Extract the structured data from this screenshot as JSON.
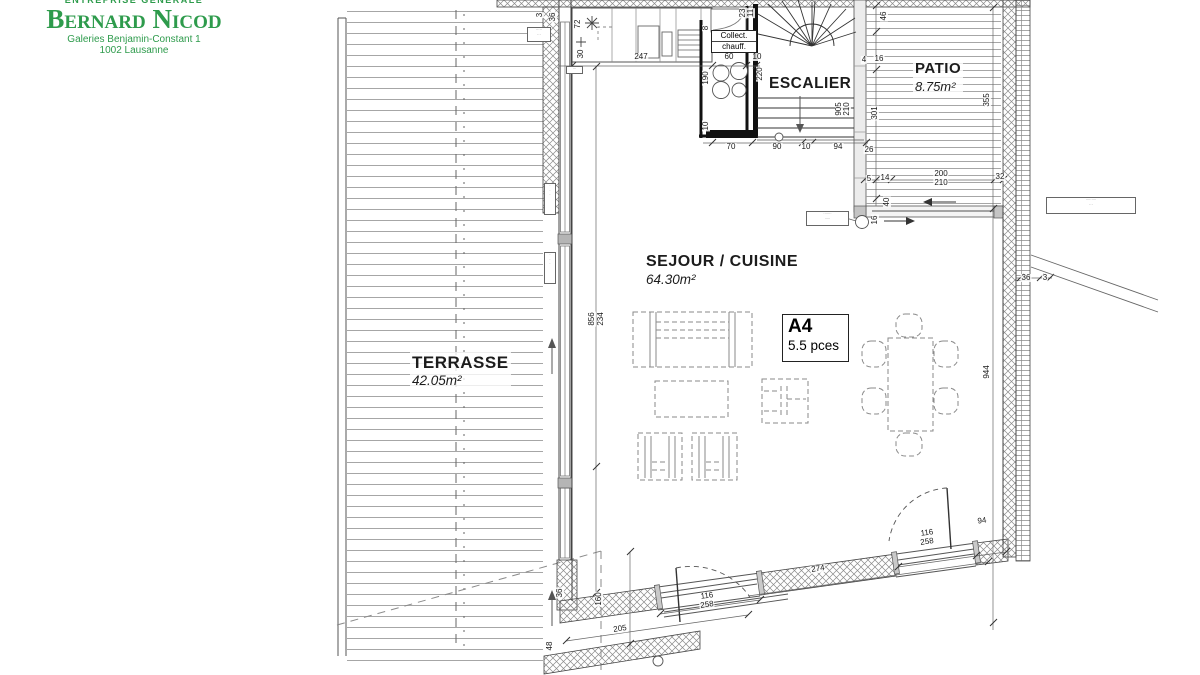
{
  "brand": {
    "tagline": "ENTREPRISE GÉNÉRALE",
    "name": "Bernard Nicod",
    "address_line1": "Galeries Benjamin-Constant 1",
    "address_line2": "1002 Lausanne",
    "color": "#2e9b4c"
  },
  "unit_badge": {
    "code": "A4",
    "size": "5.5 pces"
  },
  "rooms": [
    {
      "id": "terrasse",
      "label": "TERRASSE",
      "area": "42.05m²"
    },
    {
      "id": "sejour",
      "label": "SEJOUR / CUISINE",
      "area": "64.30m²"
    },
    {
      "id": "escalier",
      "label": "ESCALIER",
      "area": ""
    },
    {
      "id": "patio",
      "label": "PATIO",
      "area": "8.75m²"
    }
  ],
  "equipment": {
    "collect_line1": "Collect.",
    "collect_line2": "chauff."
  },
  "dimensions": [
    {
      "t": "247",
      "x": 641,
      "y": 57
    },
    {
      "t": "60",
      "x": 729,
      "y": 57
    },
    {
      "t": "10",
      "x": 757,
      "y": 57
    },
    {
      "t": "3",
      "x": 540,
      "y": 15,
      "r": -90
    },
    {
      "t": "36",
      "x": 553,
      "y": 17,
      "r": -90
    },
    {
      "t": "72",
      "x": 578,
      "y": 24,
      "r": -90
    },
    {
      "t": "30",
      "x": 581,
      "y": 54,
      "r": -90
    },
    {
      "t": "23",
      "x": 743,
      "y": 13,
      "r": -90
    },
    {
      "t": "11",
      "x": 751,
      "y": 13,
      "r": -90
    },
    {
      "t": "8",
      "x": 706,
      "y": 28,
      "r": -90
    },
    {
      "t": "190",
      "x": 706,
      "y": 78,
      "r": -90
    },
    {
      "t": "10",
      "x": 706,
      "y": 126,
      "r": -90
    },
    {
      "t": "220",
      "x": 760,
      "y": 74,
      "r": -90
    },
    {
      "t": "905",
      "x": 839,
      "y": 109,
      "r": -90
    },
    {
      "t": "210",
      "x": 847,
      "y": 109,
      "r": -90
    },
    {
      "t": "70",
      "x": 731,
      "y": 147
    },
    {
      "t": "90",
      "x": 777,
      "y": 147
    },
    {
      "t": "10",
      "x": 806,
      "y": 147
    },
    {
      "t": "94",
      "x": 838,
      "y": 147
    },
    {
      "t": "26",
      "x": 869,
      "y": 150
    },
    {
      "t": "46",
      "x": 884,
      "y": 16,
      "r": -90
    },
    {
      "t": "4",
      "x": 864,
      "y": 60
    },
    {
      "t": "16",
      "x": 879,
      "y": 59
    },
    {
      "t": "301",
      "x": 875,
      "y": 113,
      "r": -90
    },
    {
      "t": "355",
      "x": 987,
      "y": 100,
      "r": -90
    },
    {
      "t": "5",
      "x": 869,
      "y": 179
    },
    {
      "t": "14",
      "x": 885,
      "y": 178
    },
    {
      "t": "200",
      "x": 941,
      "y": 174
    },
    {
      "t": "210",
      "x": 941,
      "y": 183
    },
    {
      "t": "32",
      "x": 1000,
      "y": 177
    },
    {
      "t": "40",
      "x": 887,
      "y": 202,
      "r": -90
    },
    {
      "t": "16",
      "x": 875,
      "y": 220,
      "r": -90
    },
    {
      "t": "36",
      "x": 1026,
      "y": 278
    },
    {
      "t": "3",
      "x": 1045,
      "y": 278
    },
    {
      "t": "944",
      "x": 987,
      "y": 372,
      "r": -90
    },
    {
      "t": "856",
      "x": 592,
      "y": 319,
      "r": -90
    },
    {
      "t": "234",
      "x": 601,
      "y": 319,
      "r": -90
    },
    {
      "t": "36",
      "x": 560,
      "y": 593,
      "r": -90
    },
    {
      "t": "48",
      "x": 550,
      "y": 646,
      "r": -90
    },
    {
      "t": "160",
      "x": 599,
      "y": 599,
      "r": -90
    },
    {
      "t": "205",
      "x": 620,
      "y": 629,
      "r": -8
    },
    {
      "t": "274",
      "x": 818,
      "y": 569,
      "r": -8
    },
    {
      "t": "116",
      "x": 707,
      "y": 596,
      "r": -8
    },
    {
      "t": "258",
      "x": 707,
      "y": 605,
      "r": -8
    },
    {
      "t": "116",
      "x": 927,
      "y": 533,
      "r": -8
    },
    {
      "t": "258",
      "x": 927,
      "y": 542,
      "r": -8
    },
    {
      "t": "94",
      "x": 982,
      "y": 521,
      "r": -8
    }
  ],
  "annotations": [
    {
      "lines": [
        "·····",
        "···"
      ],
      "x": 527,
      "y": 27,
      "w": 22,
      "h": 13
    },
    {
      "lines": [
        "·",
        "·",
        "·"
      ],
      "x": 544,
      "y": 183,
      "w": 10,
      "h": 30
    },
    {
      "lines": [
        "·",
        "·",
        "·"
      ],
      "x": 544,
      "y": 252,
      "w": 10,
      "h": 30
    },
    {
      "lines": [
        "·······",
        "·····"
      ],
      "x": 806,
      "y": 211,
      "w": 41,
      "h": 13
    },
    {
      "lines": [
        "·········",
        "···"
      ],
      "x": 1046,
      "y": 197,
      "w": 88,
      "h": 15
    },
    {
      "lines": [
        "···"
      ],
      "x": 566,
      "y": 66,
      "w": 15,
      "h": 6
    }
  ]
}
